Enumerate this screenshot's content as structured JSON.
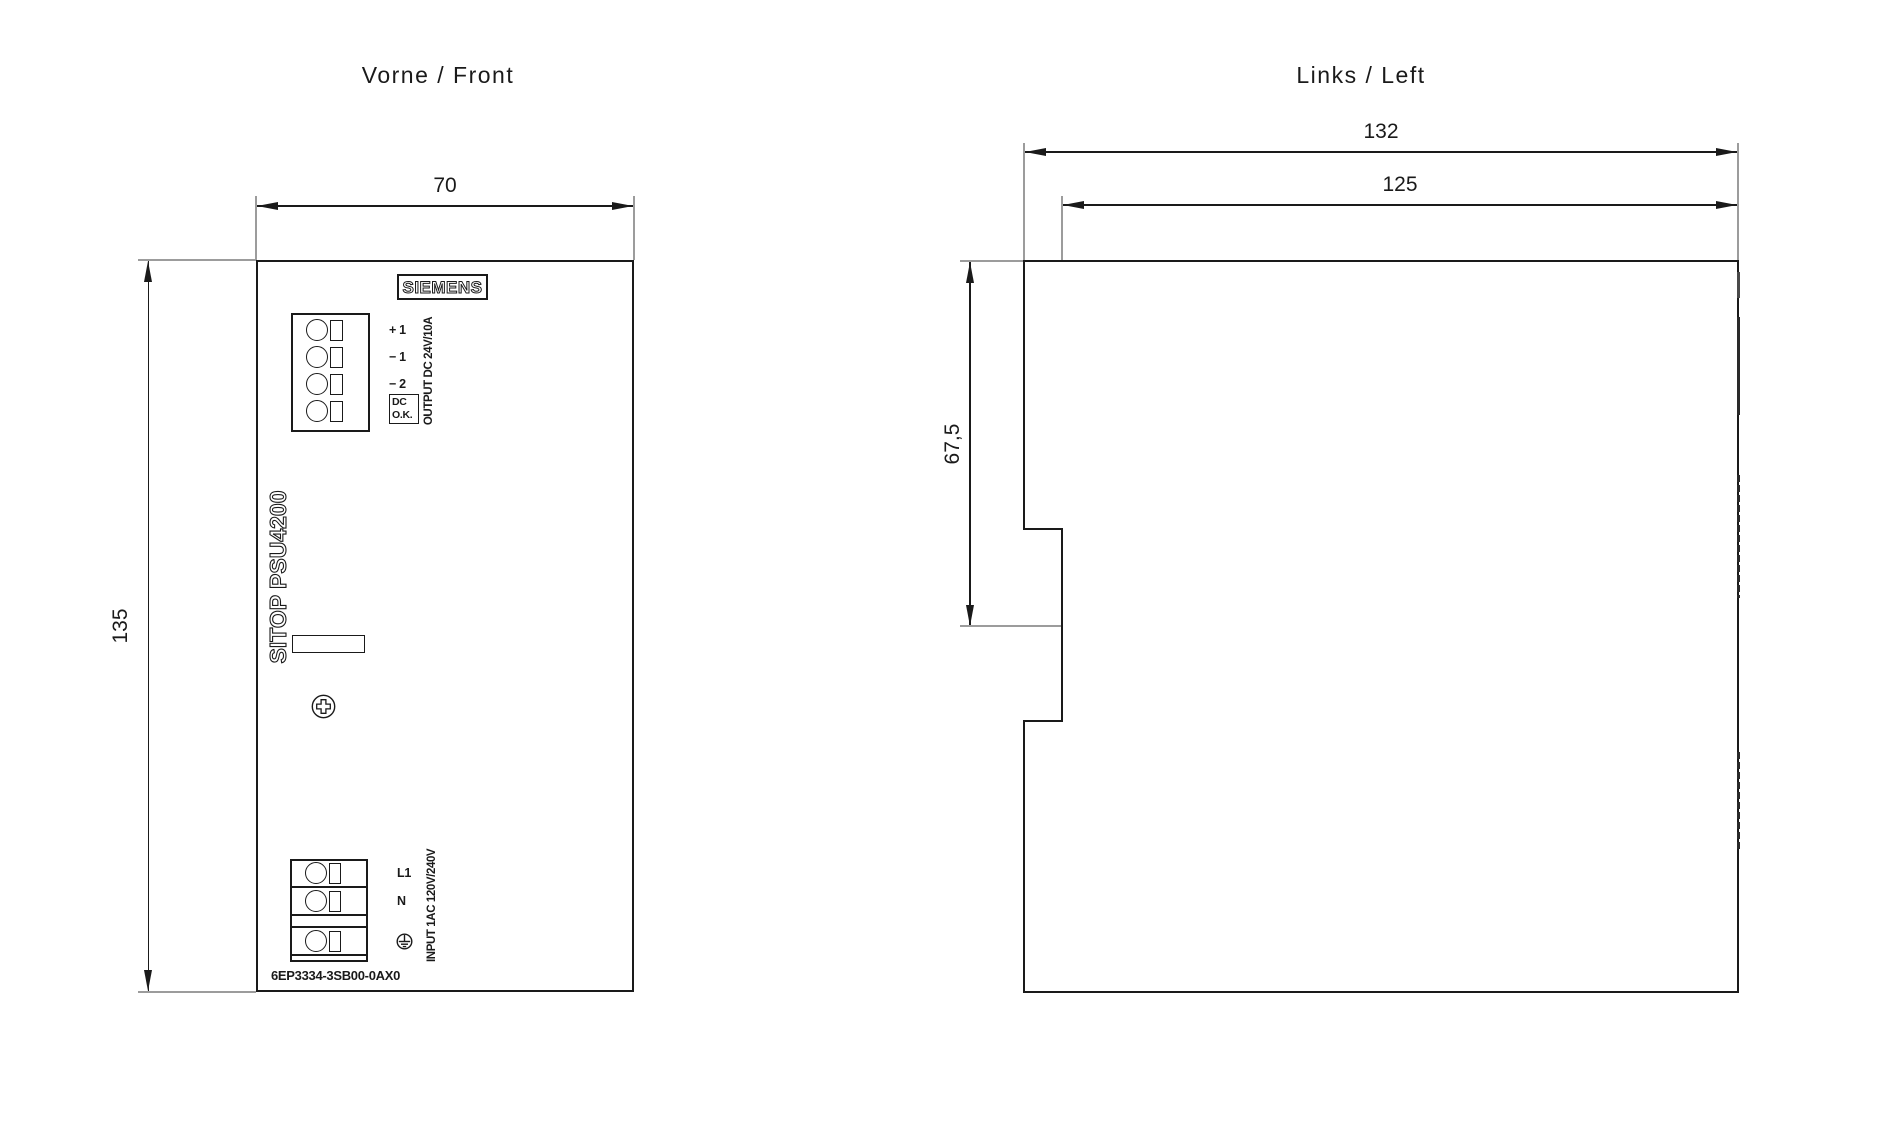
{
  "front_view": {
    "title": "Vorne / Front",
    "width_dim": "70",
    "height_dim": "135",
    "brand": "SIEMENS",
    "product": "SITOP PSU4200",
    "order_number": "6EP3334-3SB00-0AX0",
    "output": {
      "terminal_labels": [
        "+ 1",
        "− 1",
        "− 2"
      ],
      "dc_ok_line1": "DC",
      "dc_ok_line2": "O.K.",
      "rating_label": "OUTPUT DC 24V/10A"
    },
    "input": {
      "terminal_labels": [
        "L1",
        "N"
      ],
      "rating_label": "INPUT 1AC 120V/240V"
    }
  },
  "side_view": {
    "title": "Links / Left",
    "overall_depth_dim": "132",
    "body_depth_dim": "125",
    "rail_offset_dim": "67,5"
  },
  "colors": {
    "line": "#1a1a1a",
    "extension_line": "#9c9c9c",
    "background": "#ffffff"
  }
}
